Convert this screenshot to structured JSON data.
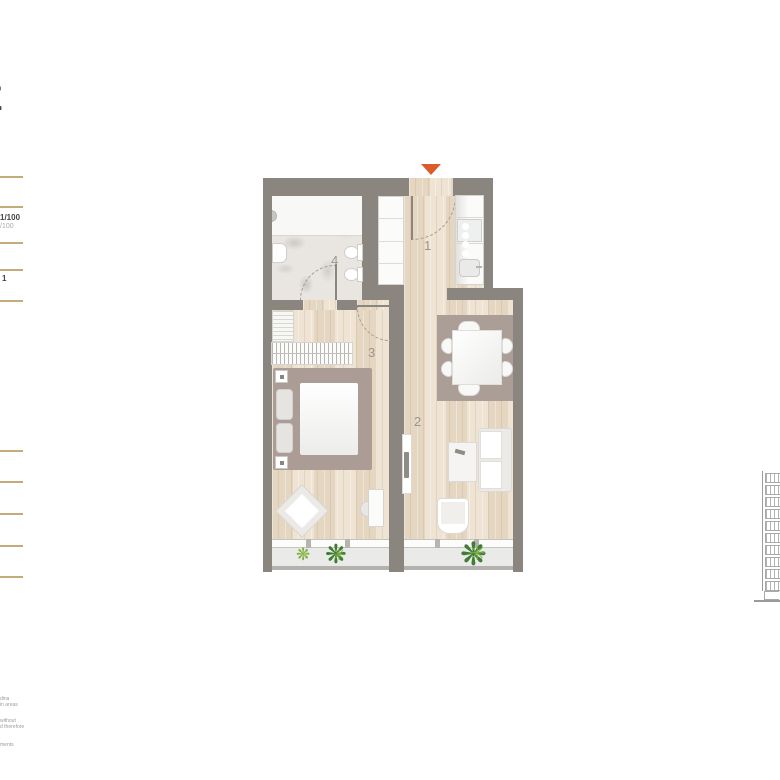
{
  "legend": {
    "title_fragment": "E",
    "scale_label": "1/100",
    "scale_sublabel": "/100",
    "level_label": "1"
  },
  "floorplan": {
    "room_labels": {
      "hall": "1",
      "living": "2",
      "bedroom": "3",
      "bathroom": "4"
    },
    "colors": {
      "wall": "#8b8580",
      "wood_floor": "#ecdfcd",
      "marble_floor": "#e9e6e2",
      "balcony_floor": "#eaeae8",
      "furniture_accent": "#ab9d96",
      "entry_arrow": "#dc5b2b",
      "room_label": "#9a948d",
      "plant_dark": "#3e7d35",
      "plant_light": "#7fae45",
      "legend_rule": "#c5aa7e"
    }
  },
  "plants": {
    "glyph": "❋",
    "glyph2": "✳"
  },
  "disclaimer": {
    "fragments": [
      "dina",
      "in areas",
      "without",
      "d therefore",
      "ments"
    ]
  },
  "elevation": {
    "floors": 10
  }
}
